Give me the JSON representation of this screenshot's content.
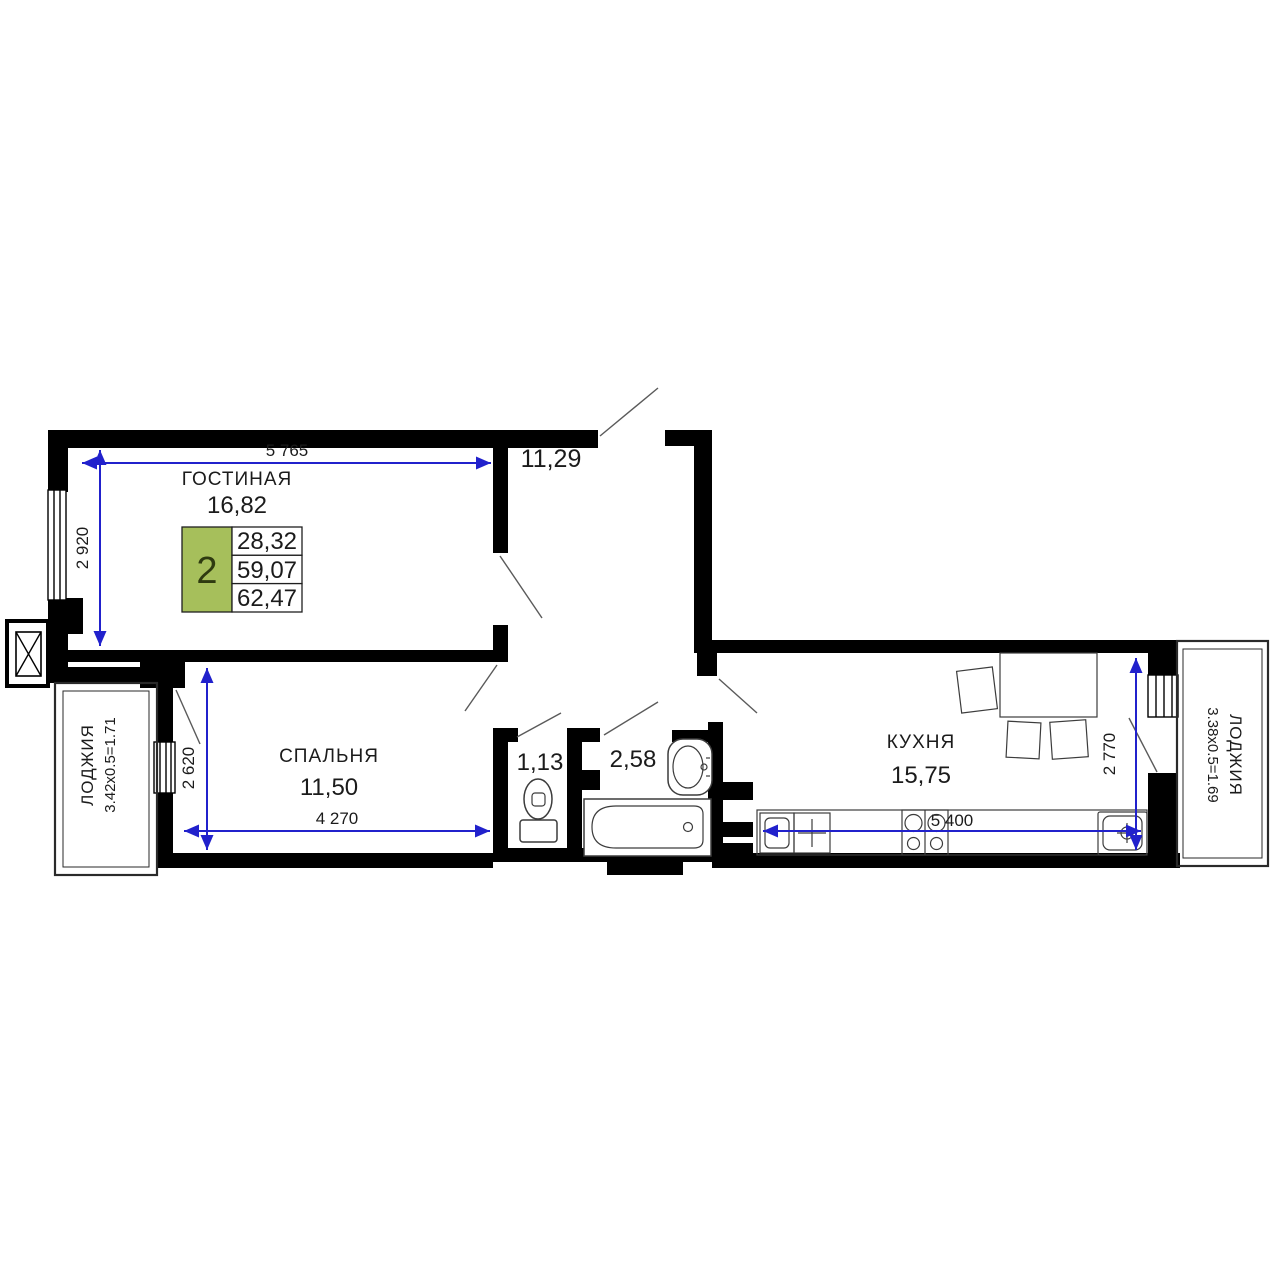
{
  "plan": {
    "labels": {
      "living_name": "ГОСТИНАЯ",
      "living_area": "16,82",
      "hall_area": "11,29",
      "bedroom_name": "СПАЛЬНЯ",
      "bedroom_area": "11,50",
      "wc_area": "1,13",
      "bath_area": "2,58",
      "kitchen_name": "КУХНЯ",
      "kitchen_area": "15,75",
      "loggia_left_name": "ЛОДЖИЯ",
      "loggia_left_formula": "3.42х0.5=1.71",
      "loggia_right_name": "ЛОДЖИЯ",
      "loggia_right_formula": "3.38х0.5=1.69"
    },
    "dims": {
      "d5765": "5 765",
      "d2920": "2 920",
      "d2620": "2 620",
      "d4270": "4 270",
      "d5400": "5 400",
      "d2770": "2 770"
    },
    "badge": {
      "rooms": "2",
      "values": [
        "28,32",
        "59,07",
        "62,47"
      ]
    },
    "colors": {
      "wall": "#000000",
      "dimension_blue": "#2121cc",
      "badge_green": "#a6bf5b"
    }
  }
}
